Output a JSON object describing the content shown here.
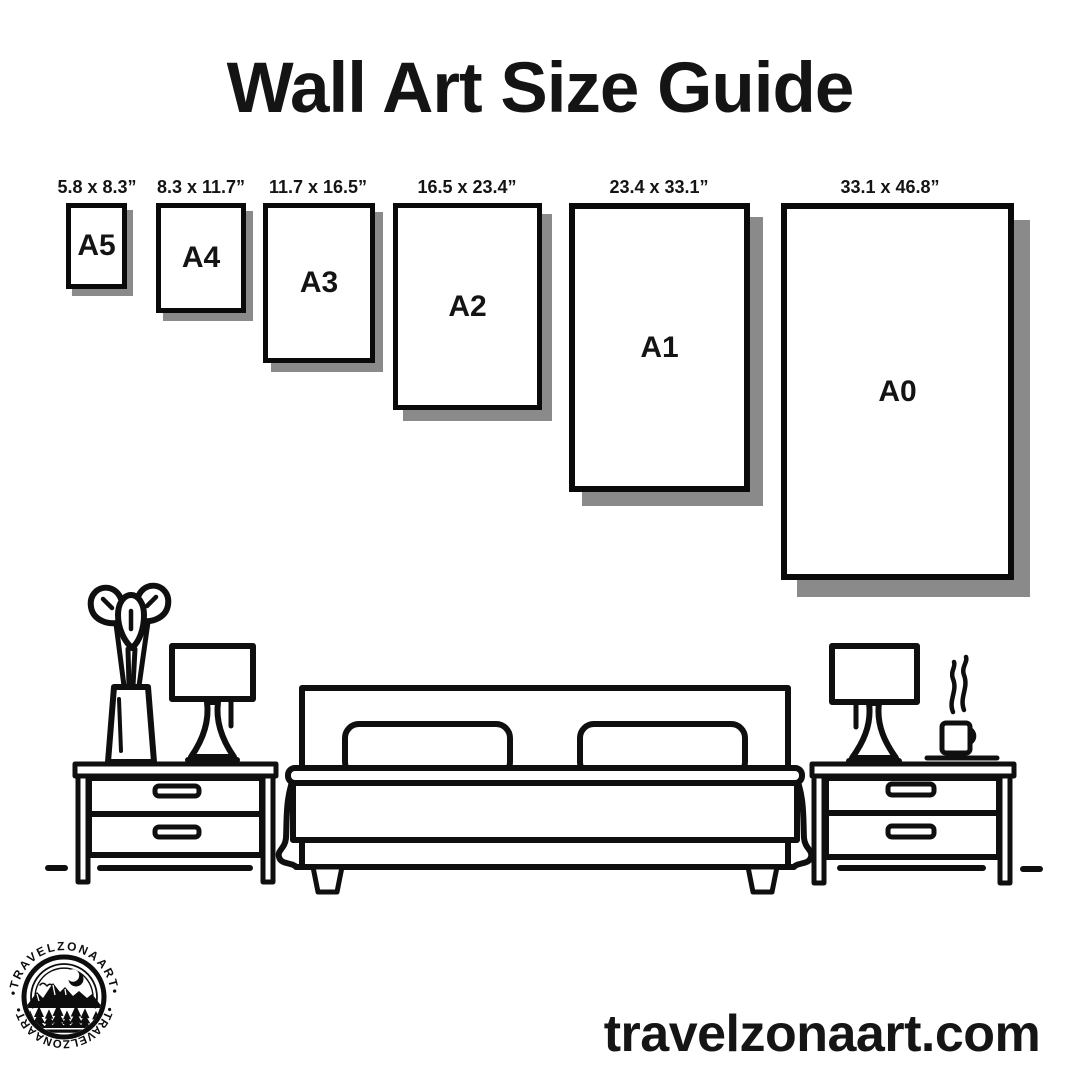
{
  "title": "Wall Art Size Guide",
  "papers": {
    "a5": {
      "name": "A5",
      "dims": "5.8 x 8.3”"
    },
    "a4": {
      "name": "A4",
      "dims": "8.3 x 11.7”"
    },
    "a3": {
      "name": "A3",
      "dims": "11.7 x 16.5”"
    },
    "a2": {
      "name": "A2",
      "dims": "16.5 x 23.4”"
    },
    "a1": {
      "name": "A1",
      "dims": "23.4 x 33.1”"
    },
    "a0": {
      "name": "A0",
      "dims": "33.1 x 46.8”"
    }
  },
  "logo": {
    "ring_text_top": "•TRAVELZONAART•",
    "ring_text_bottom": "•TRAVELZONAART•"
  },
  "footer": {
    "website": "travelzonaart.com"
  },
  "colors": {
    "ink": "#0f0f0f",
    "shadow": "#8a8a8a",
    "background": "#ffffff"
  }
}
